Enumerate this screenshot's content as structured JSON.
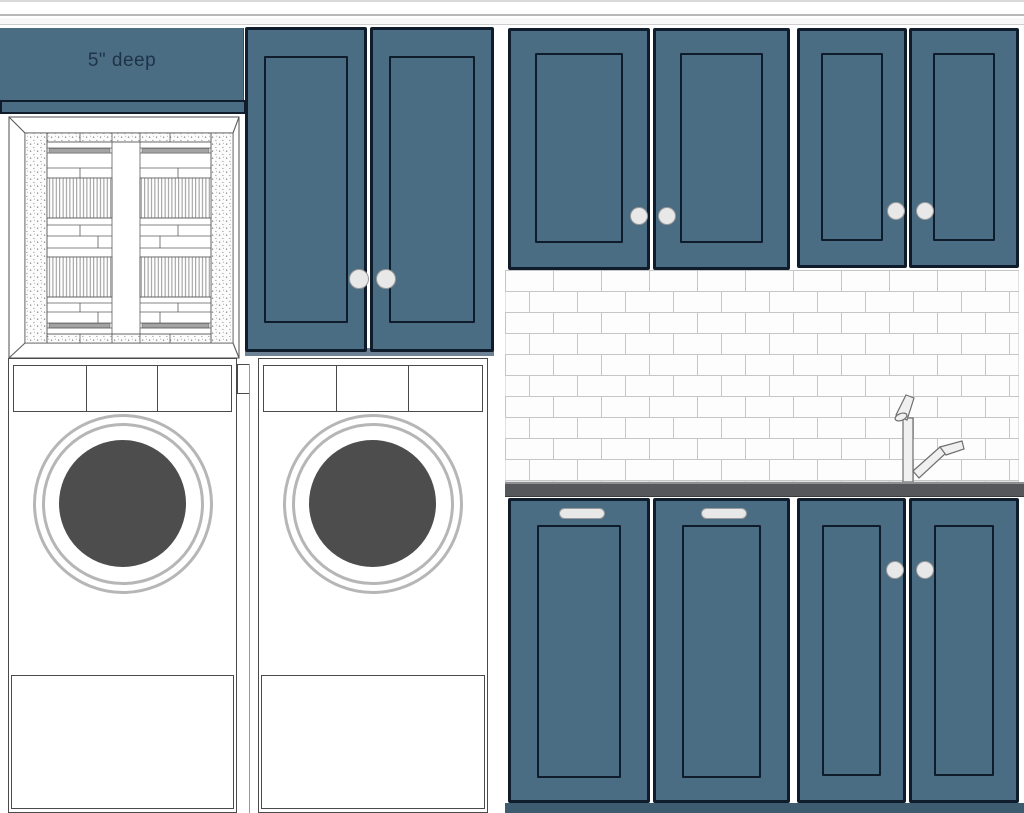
{
  "note": {
    "label": "5\" deep"
  },
  "colors": {
    "cabinet-blue": "#4b6d84",
    "outline-navy": "#0e1c2c",
    "note-text": "#1d3348",
    "countertop": "#55575a",
    "countertop-edge": "#8e9092",
    "toe-kick": "#3e5c70",
    "tall-base": "#6d8294",
    "grout": "#c6c6c6",
    "tile": "#fdfdfd",
    "drum": "#4d4d4d",
    "ring": "#b6b6b6",
    "appliance-line": "#4a4a4a",
    "hardware": "#e8e8e8",
    "hardware-edge": "#9a9a9a",
    "faucet-fill": "#f0f0f0",
    "faucet-line": "#6f6f6f",
    "window-line": "#5c5c5c",
    "stipple-dot": "#707070",
    "stripe-line": "#8a8a8a",
    "glass-bar": "#a3a3a3"
  },
  "inventory": {
    "washer_count": 2,
    "tall_cabinet_doors": 2,
    "upper_cabinet_doors": 4,
    "base_cabinet_doors": 4,
    "backsplash": "white subway tile",
    "shelf_note": "5\" deep"
  }
}
